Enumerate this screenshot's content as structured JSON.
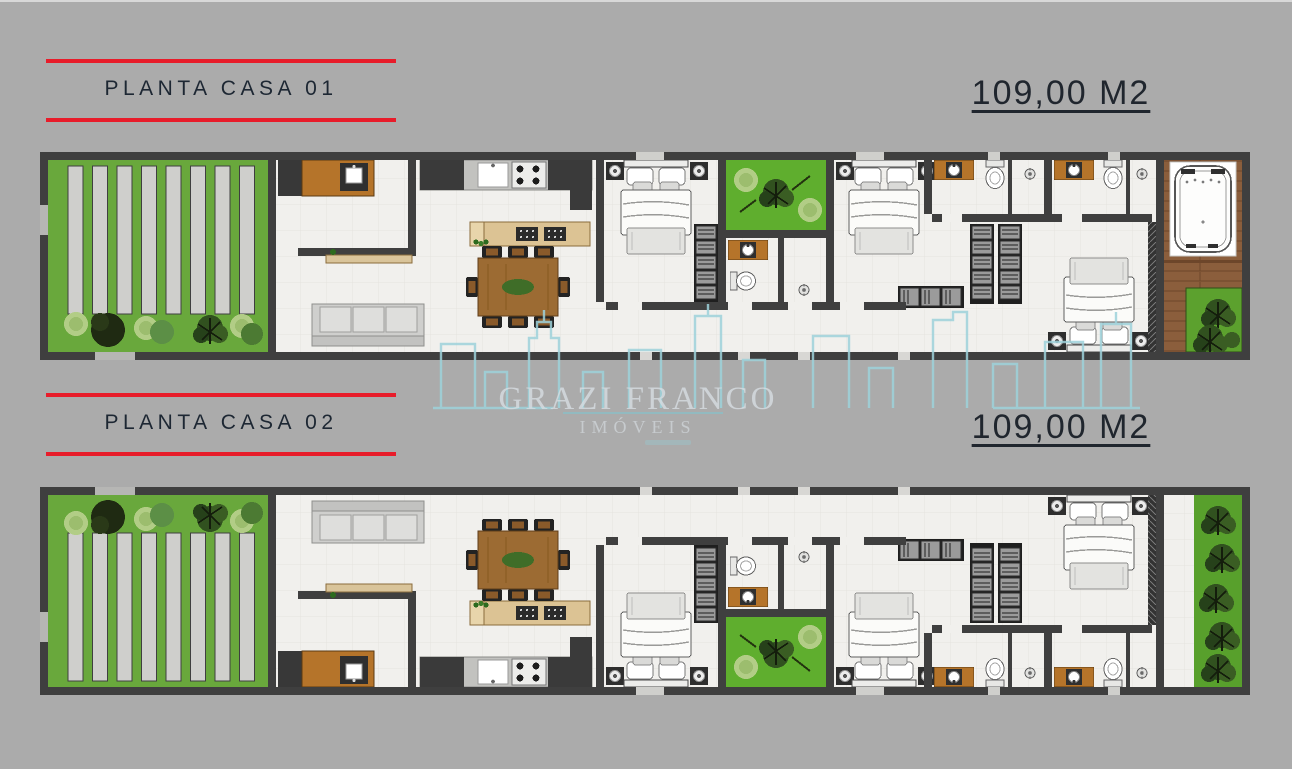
{
  "page": {
    "background_color": "#ababab",
    "accent_red": "#e81c2a",
    "title_text_color": "#1d2733"
  },
  "plans": [
    {
      "id": "casa-01",
      "title": "PLANTA CASA 01",
      "area": "109,00 M2"
    },
    {
      "id": "casa-02",
      "title": "PLANTA CASA 02",
      "area": "109,00 M2"
    }
  ],
  "watermark": {
    "name": "GRAZI FRANCO",
    "subtitle": "IMÓVEIS",
    "logo_icon": "city-skyline-icon",
    "logo_color": "#9ed2db",
    "text_color": "#d6dce0"
  }
}
